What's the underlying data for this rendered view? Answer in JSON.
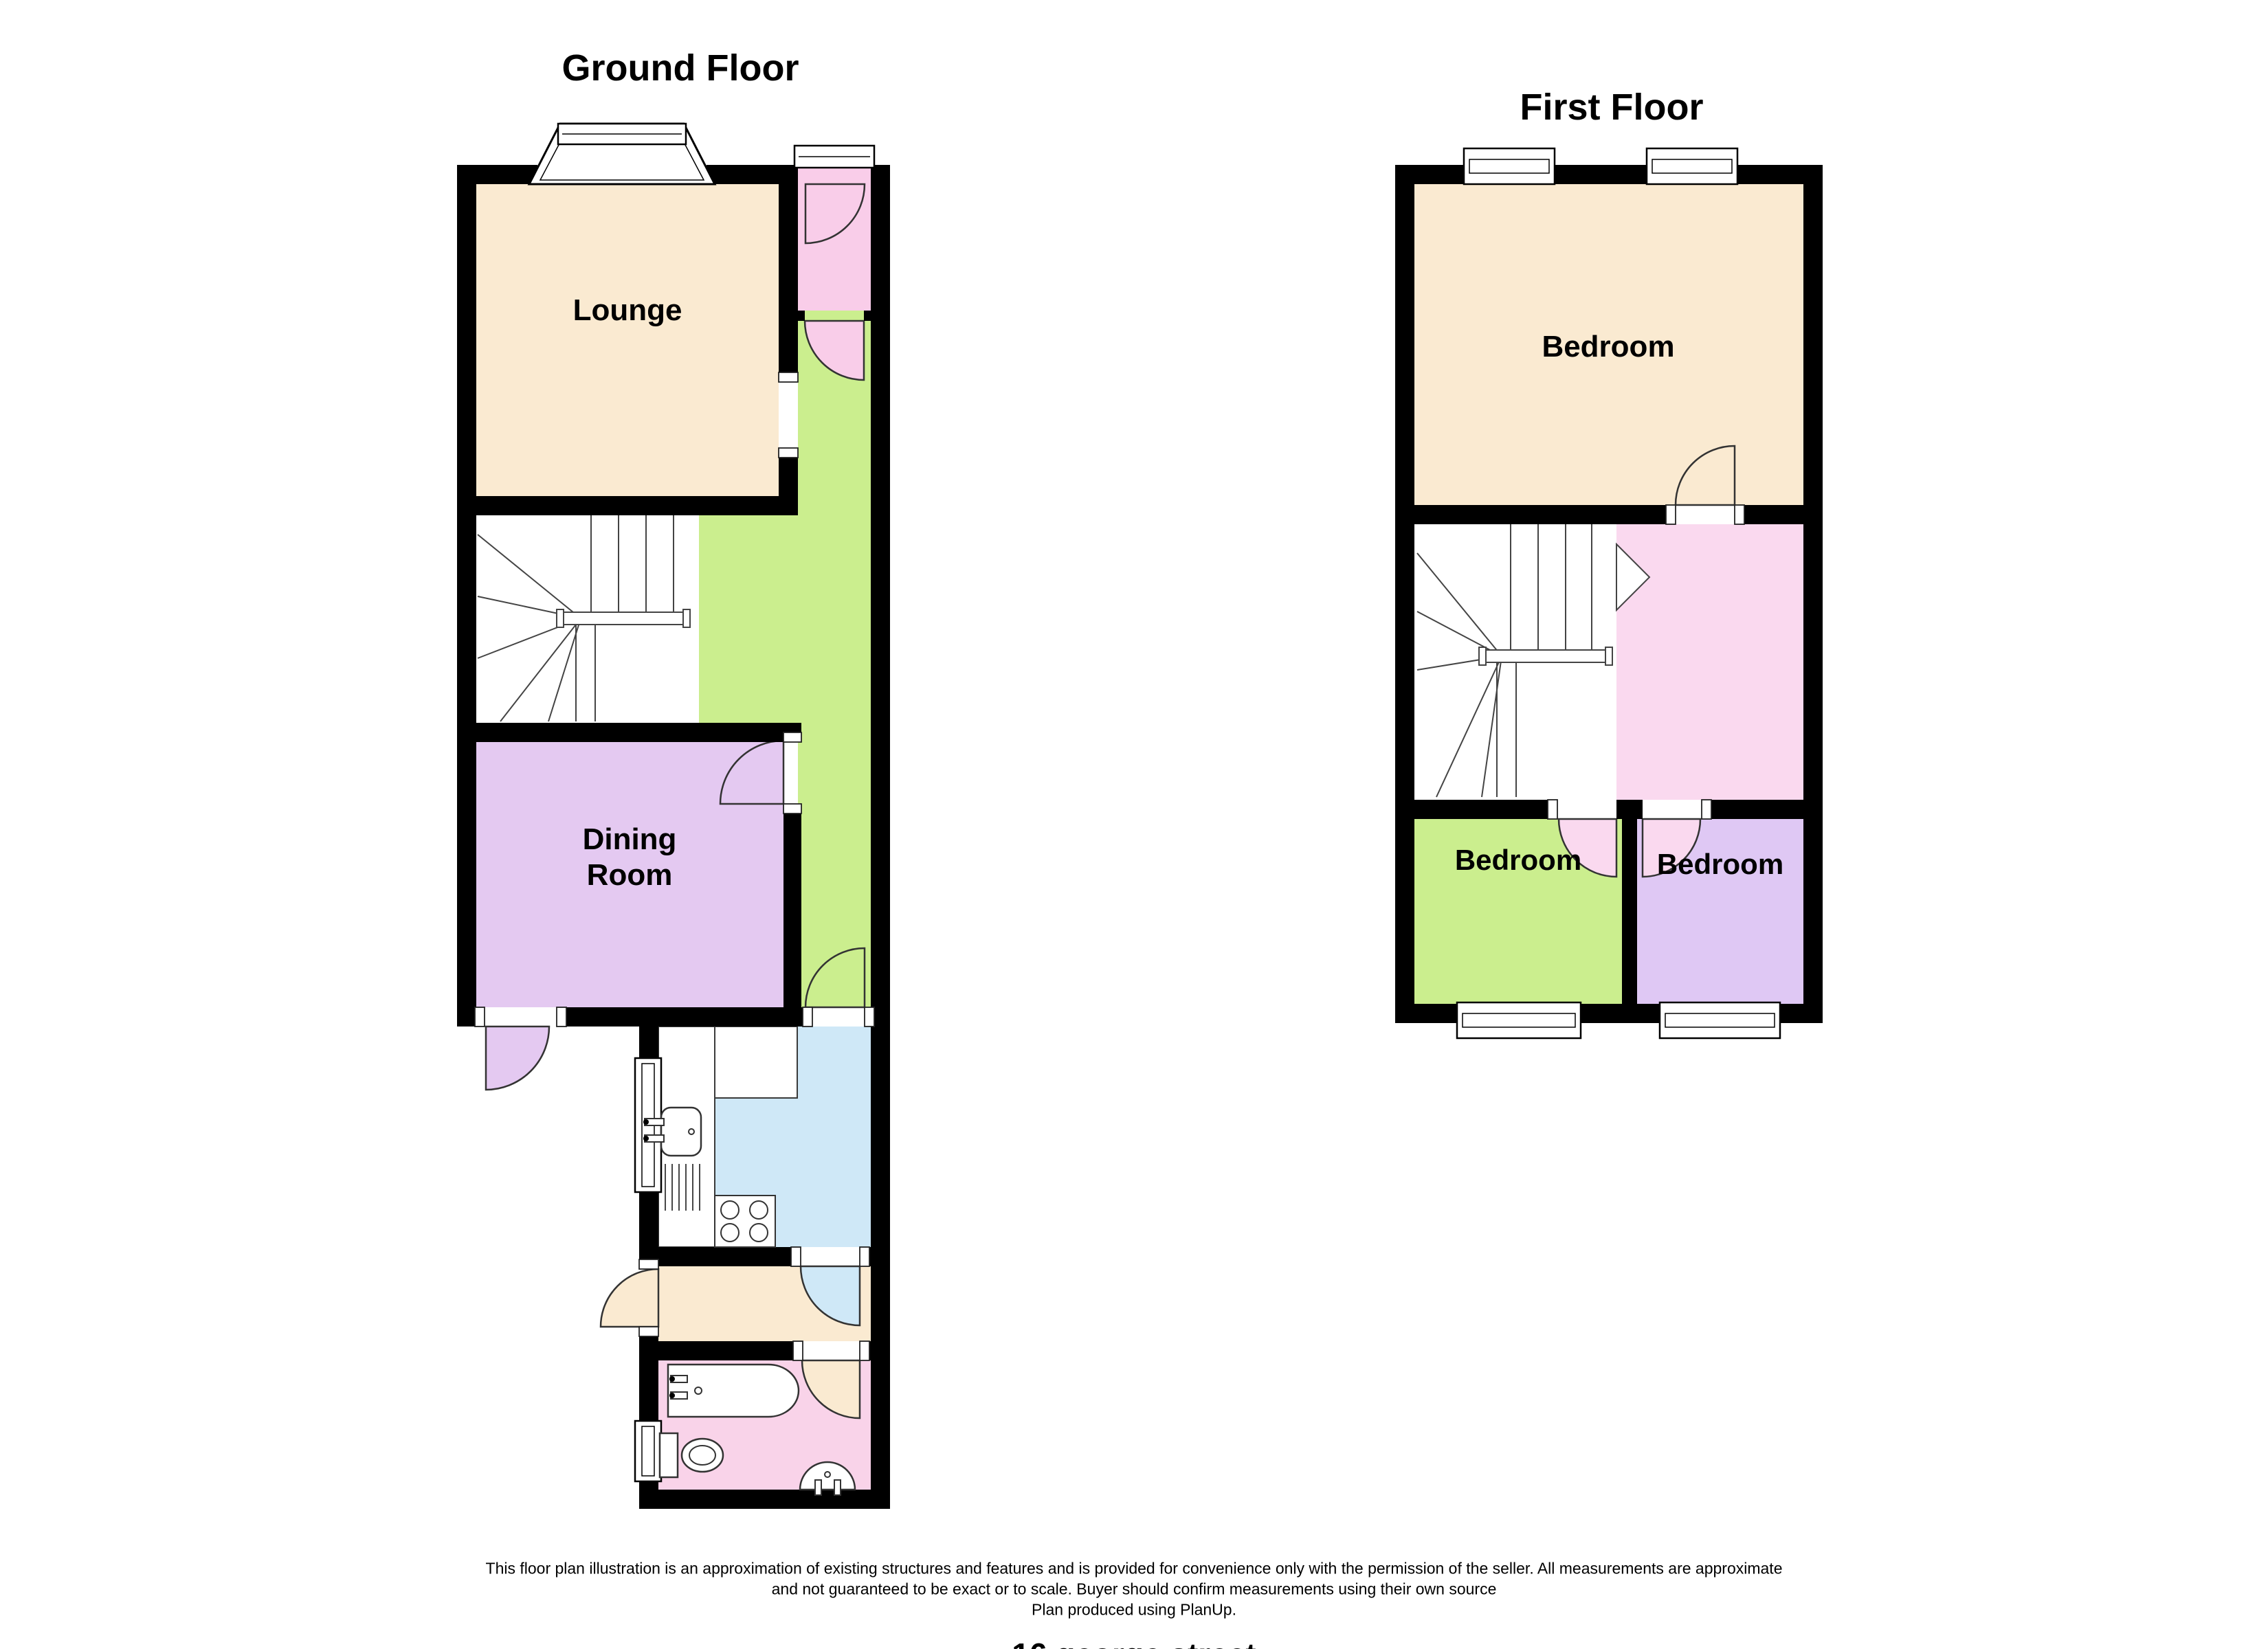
{
  "ground_floor": {
    "title": "Ground Floor",
    "rooms": {
      "lounge": "Lounge",
      "dining": "Dining Room"
    }
  },
  "first_floor": {
    "title": "First Floor",
    "rooms": {
      "bedroom_large": "Bedroom",
      "bedroom_green": "Bedroom",
      "bedroom_purple": "Bedroom"
    }
  },
  "footer": {
    "disclaimer_line1": "This floor plan illustration is an approximation of existing structures and features and is provided for convenience only with the permission of the seller. All measurements are approximate",
    "disclaimer_line2": "and not guaranteed to be exact or to scale. Buyer should confirm measurements using their own source",
    "disclaimer_line3": "Plan produced using PlanUp.",
    "address": "16 george street"
  },
  "colors": {
    "wall": "#000000",
    "cream": "#FAEAD1",
    "green": "#CBEE8E",
    "dining_purple": "#E4C9F1",
    "bedroom_purple": "#DFC8F4",
    "kitchen_blue": "#CFE8F7",
    "entrance_pink": "#F9CDE9",
    "landing_pink": "#FAD9EF",
    "bath_pink": "#F9D3E9",
    "fixture_stroke": "#3a3a3a"
  }
}
